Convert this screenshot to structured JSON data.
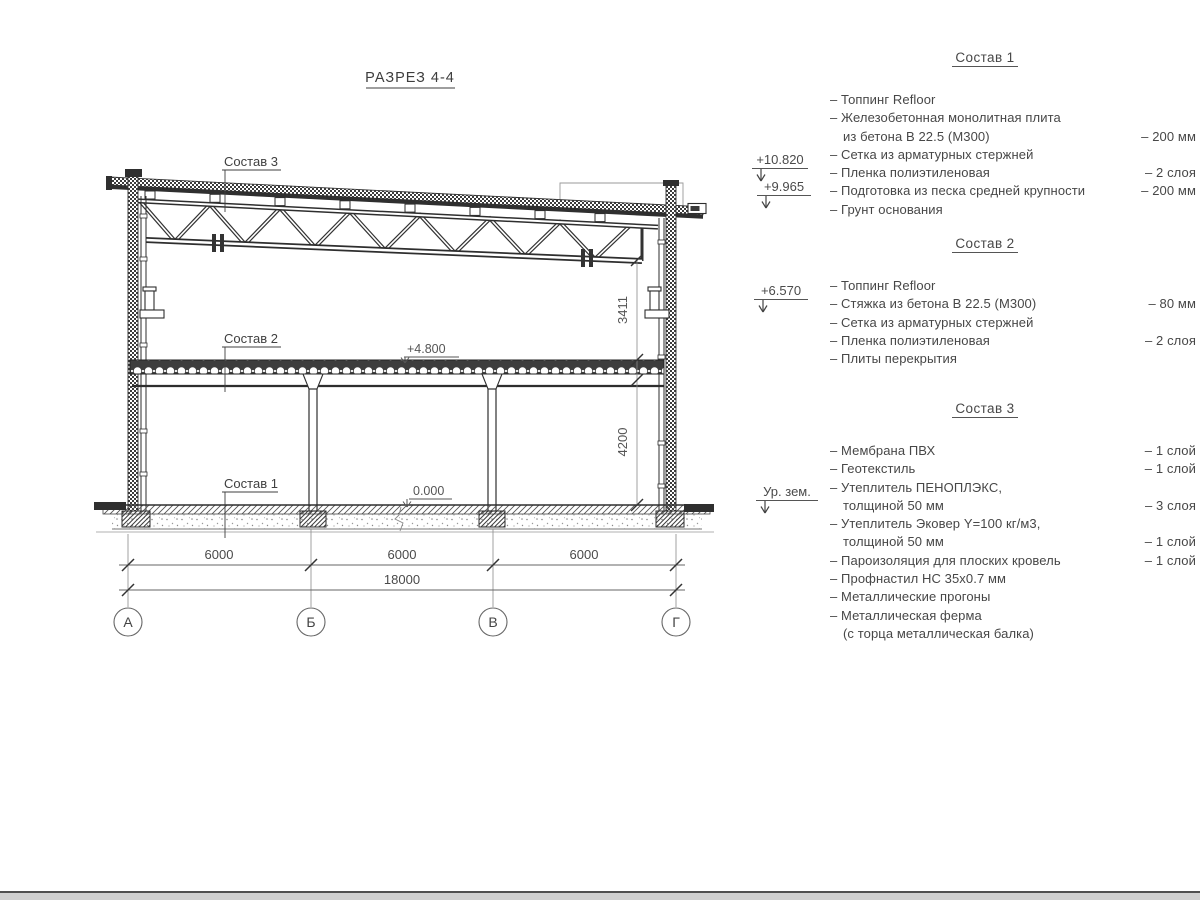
{
  "title": "РАЗРЕЗ 4-4",
  "drawing": {
    "composition_labels": {
      "c1": "Состав 1",
      "c2": "Состав 2",
      "c3": "Состав 3"
    },
    "elevation_marks": {
      "floor": "+4.800",
      "zero": "0.000"
    },
    "dims": {
      "truss": "3411",
      "story": "4200",
      "spans": [
        "6000",
        "6000",
        "6000"
      ],
      "total": "18000"
    },
    "axes": [
      "А",
      "Б",
      "В",
      "Г"
    ]
  },
  "margin_elevations": {
    "roof_high": "+10.820",
    "roof_low": "+9.965",
    "crane": "+6.570",
    "ground": "Ур. зем."
  },
  "specs": [
    {
      "heading": "Состав 1",
      "rows": [
        {
          "t": "– Топпинг Refloor",
          "v": ""
        },
        {
          "t": "– Железобетонная  монолитная плита",
          "v": ""
        },
        {
          "t": "из бетона В 22.5 (М300)",
          "v": "– 200 мм"
        },
        {
          "t": "– Сетка из арматурных стержней",
          "v": ""
        },
        {
          "t": "– Пленка полиэтиленовая",
          "v": "– 2 слоя"
        },
        {
          "t": "– Подготовка из песка средней крупности",
          "v": "– 200 мм"
        },
        {
          "t": "– Грунт основания",
          "v": ""
        }
      ]
    },
    {
      "heading": "Состав 2",
      "rows": [
        {
          "t": "– Топпинг Refloor",
          "v": ""
        },
        {
          "t": "– Стяжка из бетона В 22.5 (М300)",
          "v": "– 80 мм"
        },
        {
          "t": "– Сетка из арматурных стержней",
          "v": ""
        },
        {
          "t": "– Пленка полиэтиленовая",
          "v": "– 2 слоя"
        },
        {
          "t": "– Плиты перекрытия",
          "v": ""
        }
      ]
    },
    {
      "heading": "Состав 3",
      "rows": [
        {
          "t": "– Мембрана ПВХ",
          "v": "– 1 слой"
        },
        {
          "t": "– Геотекстиль",
          "v": "– 1 слой"
        },
        {
          "t": "– Утеплитель ПЕНОПЛЭКС,",
          "v": ""
        },
        {
          "t": "толщиной 50 мм",
          "v": "– 3 слоя"
        },
        {
          "t": "– Утеплитель Эковер Y=100 кг/м3,",
          "v": ""
        },
        {
          "t": "толщиной 50 мм",
          "v": "– 1 слой"
        },
        {
          "t": "– Пароизоляция для плоских кровель",
          "v": "– 1 слой"
        },
        {
          "t": "– Профнастил НС 35х0.7 мм",
          "v": ""
        },
        {
          "t": "– Металлические прогоны",
          "v": ""
        },
        {
          "t": "– Металлическая ферма",
          "v": ""
        },
        {
          "t": "(с торца металлическая балка)",
          "v": ""
        }
      ]
    }
  ]
}
